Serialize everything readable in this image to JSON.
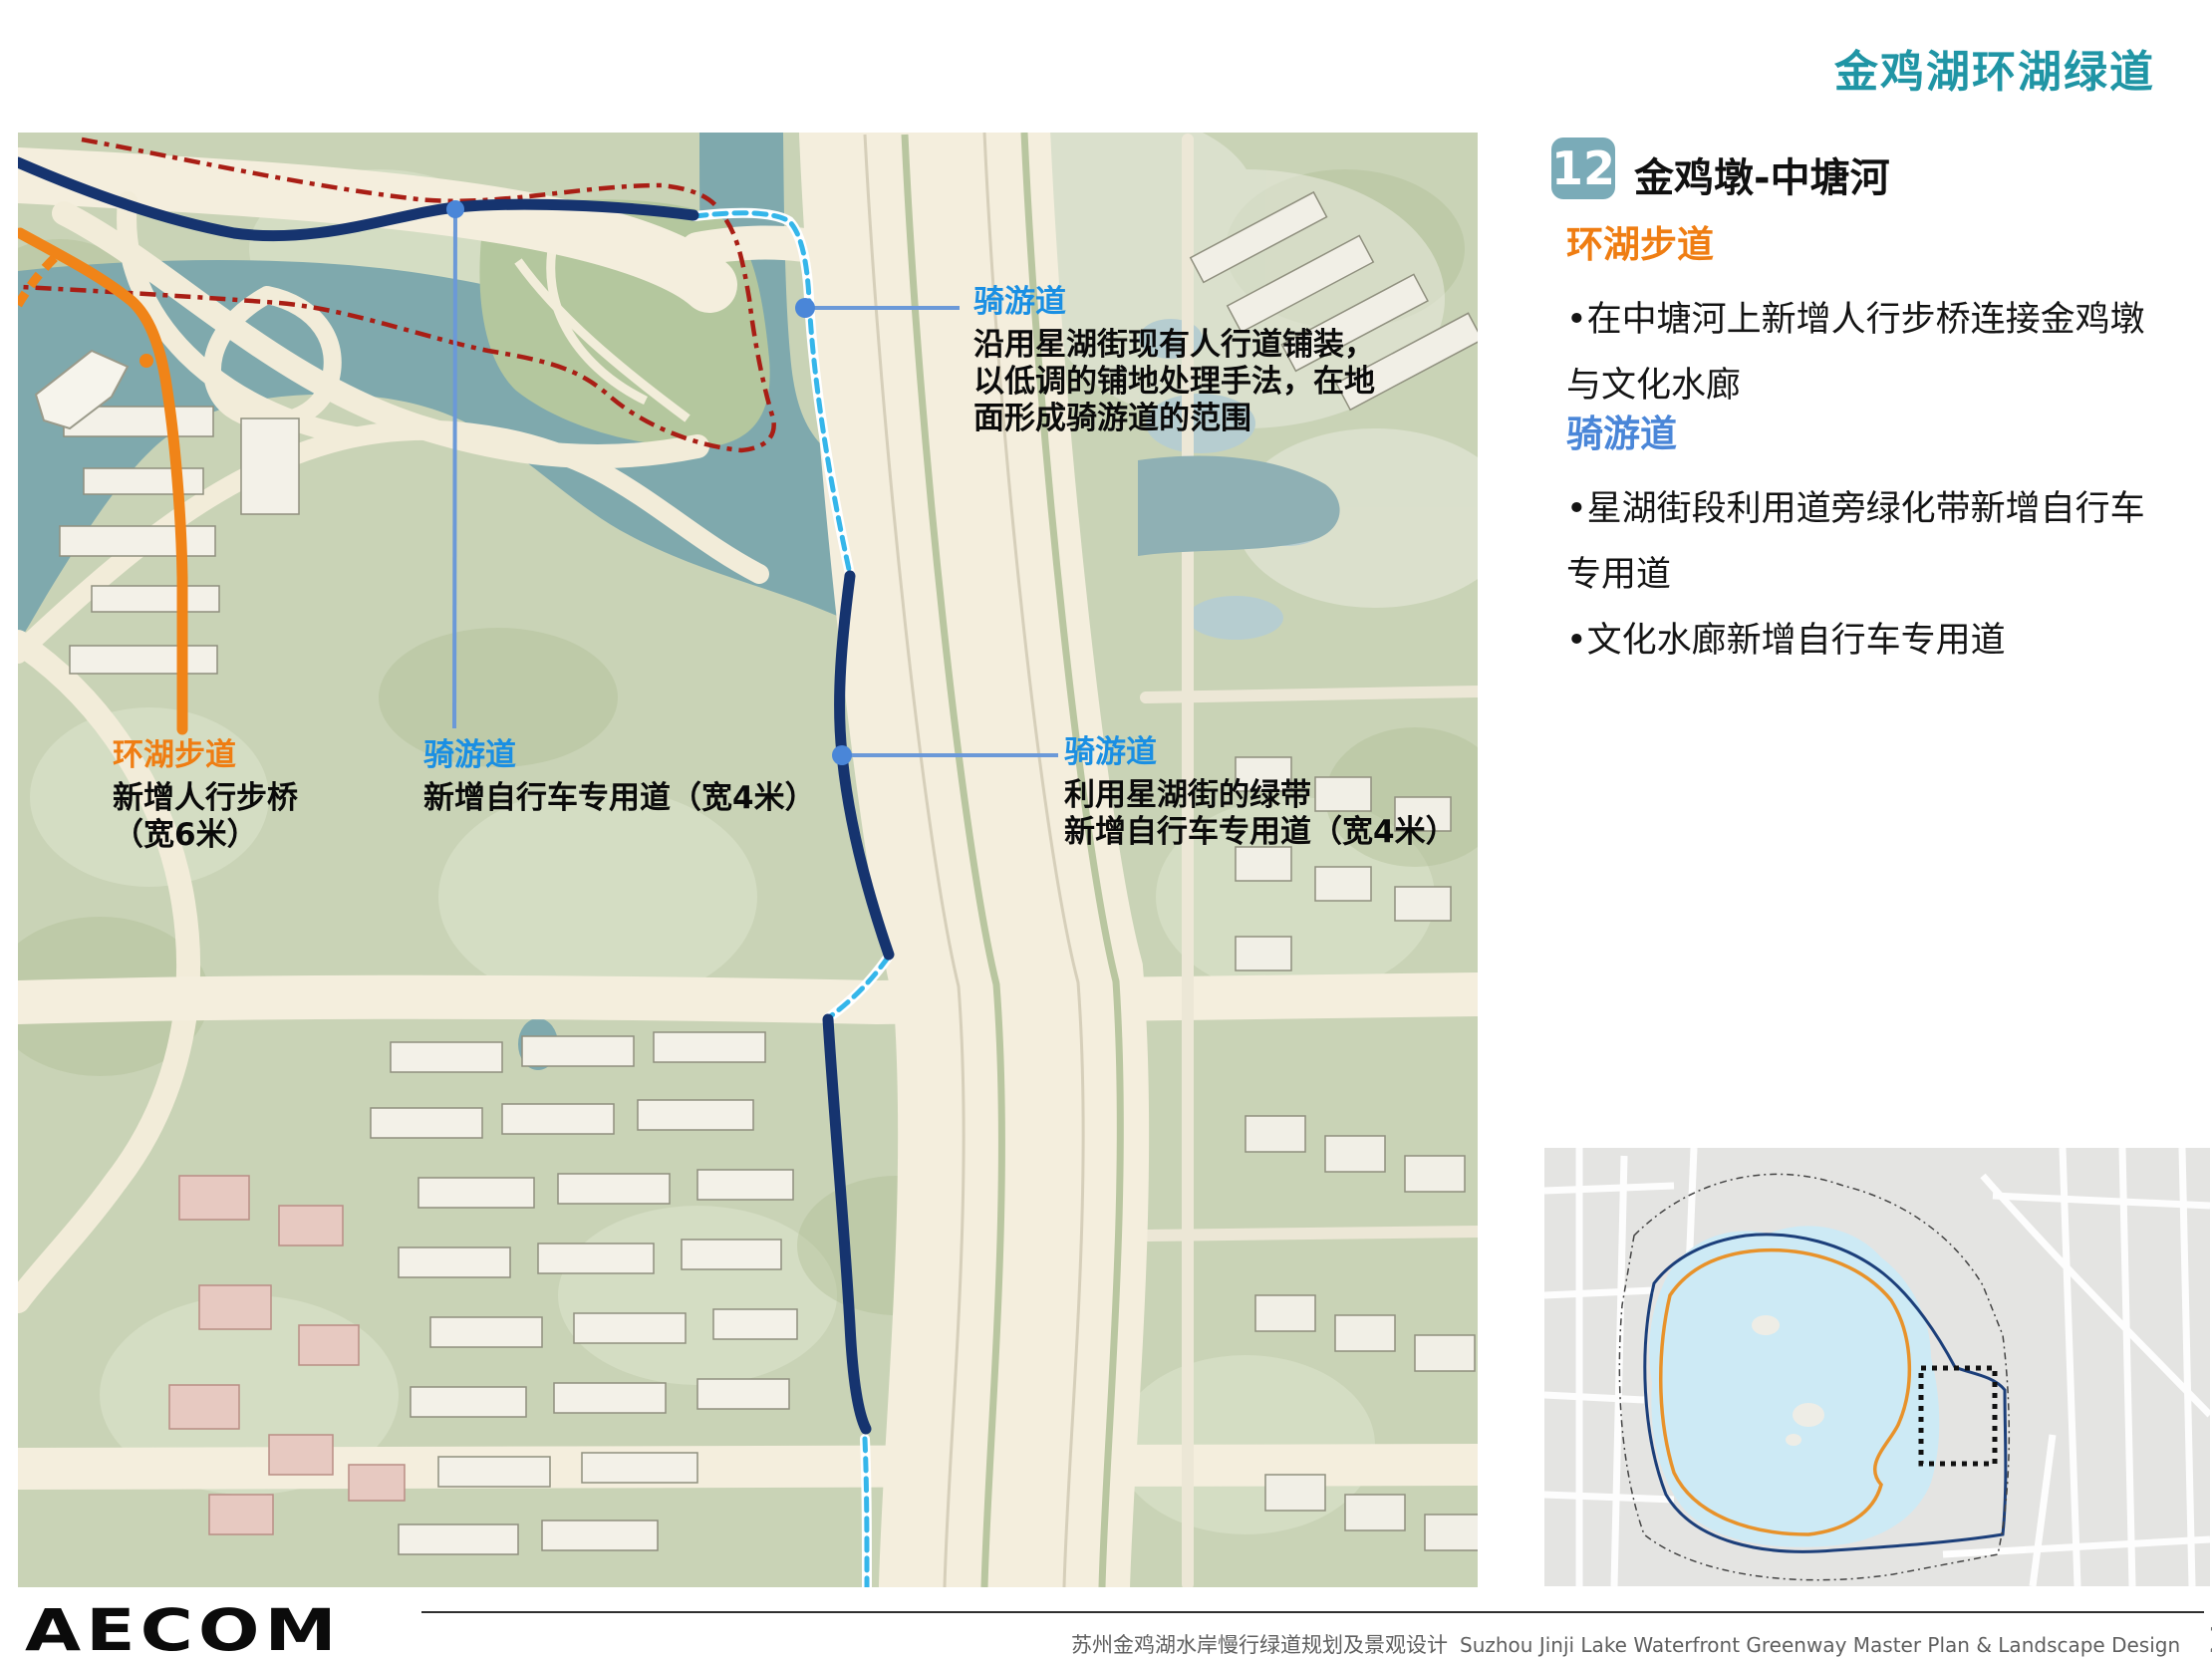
{
  "header": {
    "title": "金鸡湖环湖绿道"
  },
  "panel": {
    "badge": "12",
    "title": "金鸡墩-中塘河",
    "walkway": {
      "heading": "环湖步道",
      "bullet": "•在中塘河上新增人行步桥连接金鸡墩与文化水廊"
    },
    "cycleway": {
      "heading": "骑游道",
      "bullet1": "•星湖街段利用道旁绿化带新增自行车专用道",
      "bullet2": "•文化水廊新增自行车专用道"
    }
  },
  "map": {
    "callouts": [
      {
        "title": "骑游道",
        "lines": [
          "沿用星湖街现有人行道铺装，",
          "以低调的铺地处理手法，在地",
          "面形成骑游道的范围"
        ]
      },
      {
        "title": "环湖步道",
        "lines": [
          "新增人行步桥",
          "（宽6米）"
        ]
      },
      {
        "title": "骑游道",
        "lines": [
          "新增自行车专用道（宽4米）"
        ]
      },
      {
        "title": "骑游道",
        "lines": [
          "利用星湖街的绿带",
          "新增自行车专用道（宽4米）"
        ]
      }
    ]
  },
  "footer": {
    "logo": "AECOM",
    "title_zh": "苏州金鸡湖水岸慢行绿道规划及景观设计",
    "title_en": "Suzhou Jinji Lake Waterfront Greenway  Master Plan & Landscape Design",
    "page_number": "25"
  },
  "colors": {
    "accent_teal": "#2095a5",
    "heading_orange": "#ef7d12",
    "heading_blue": "#4a86d8",
    "label_blue": "#1a8fe3",
    "route_navy": "#16346f",
    "route_cyan": "#35b6ea",
    "route_orange": "#f08418",
    "boundary_red": "#a91e15",
    "leader_blue": "#6b99d8",
    "badge_teal": "#7aabb8",
    "water_teal": "#7fa9ad",
    "minimap_lake": "#cdeaf5"
  }
}
